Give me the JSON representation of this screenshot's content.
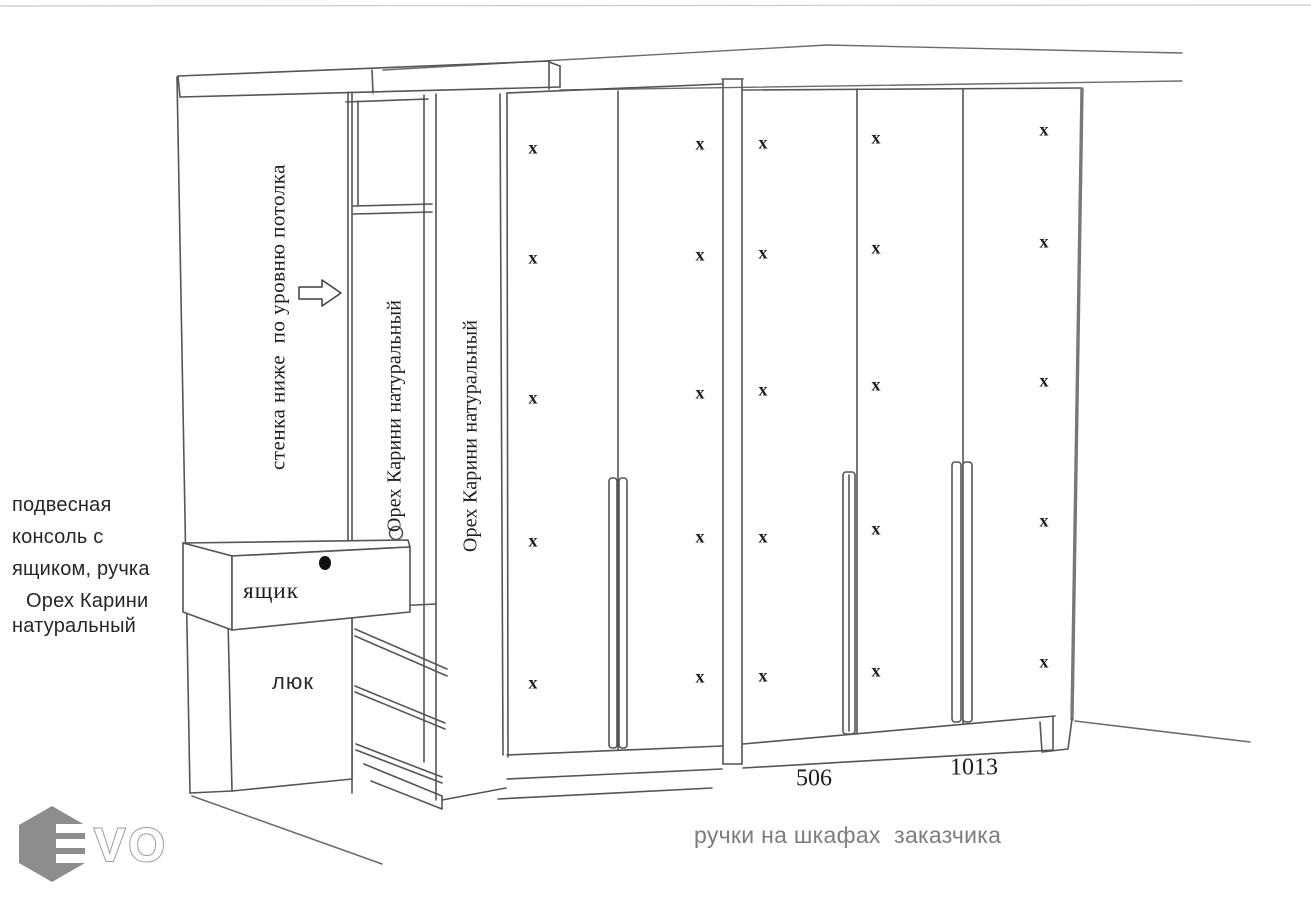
{
  "drawing": {
    "wall_note": "стенка ниже  по уровню потолка",
    "material_note_1": "Орех Карини натуральный",
    "material_note_2": "Орех Карини натуральный",
    "console_note": {
      "lines": [
        "подвесная",
        "консоль с",
        "ящиком, ручка",
        "Орех Карини",
        "натуральный"
      ]
    },
    "drawer_label": "ящик",
    "hatch_label": "люк",
    "dimensions": {
      "left_handle": "506",
      "right_handle": "1013"
    },
    "handles_note": "ручки на шкафах  заказчика",
    "hinge_mark": "x",
    "hinge_marks": {
      "columns": [
        {
          "x": 533,
          "ys": [
            148,
            258,
            398,
            541,
            683
          ]
        },
        {
          "x": 700,
          "ys": [
            144,
            255,
            393,
            537,
            677
          ]
        },
        {
          "x": 763,
          "ys": [
            143,
            253,
            390,
            537,
            676
          ]
        },
        {
          "x": 876,
          "ys": [
            138,
            248,
            385,
            529,
            671
          ]
        },
        {
          "x": 1044,
          "ys": [
            130,
            242,
            381,
            521,
            662
          ]
        }
      ]
    }
  },
  "logo": {
    "vo": "VO"
  },
  "colors": {
    "line": "#555555",
    "edge": "#787878",
    "text": "#1f1f1f",
    "gray_text": "#7d7d7d",
    "logo_gray": "#8d8d8d"
  }
}
